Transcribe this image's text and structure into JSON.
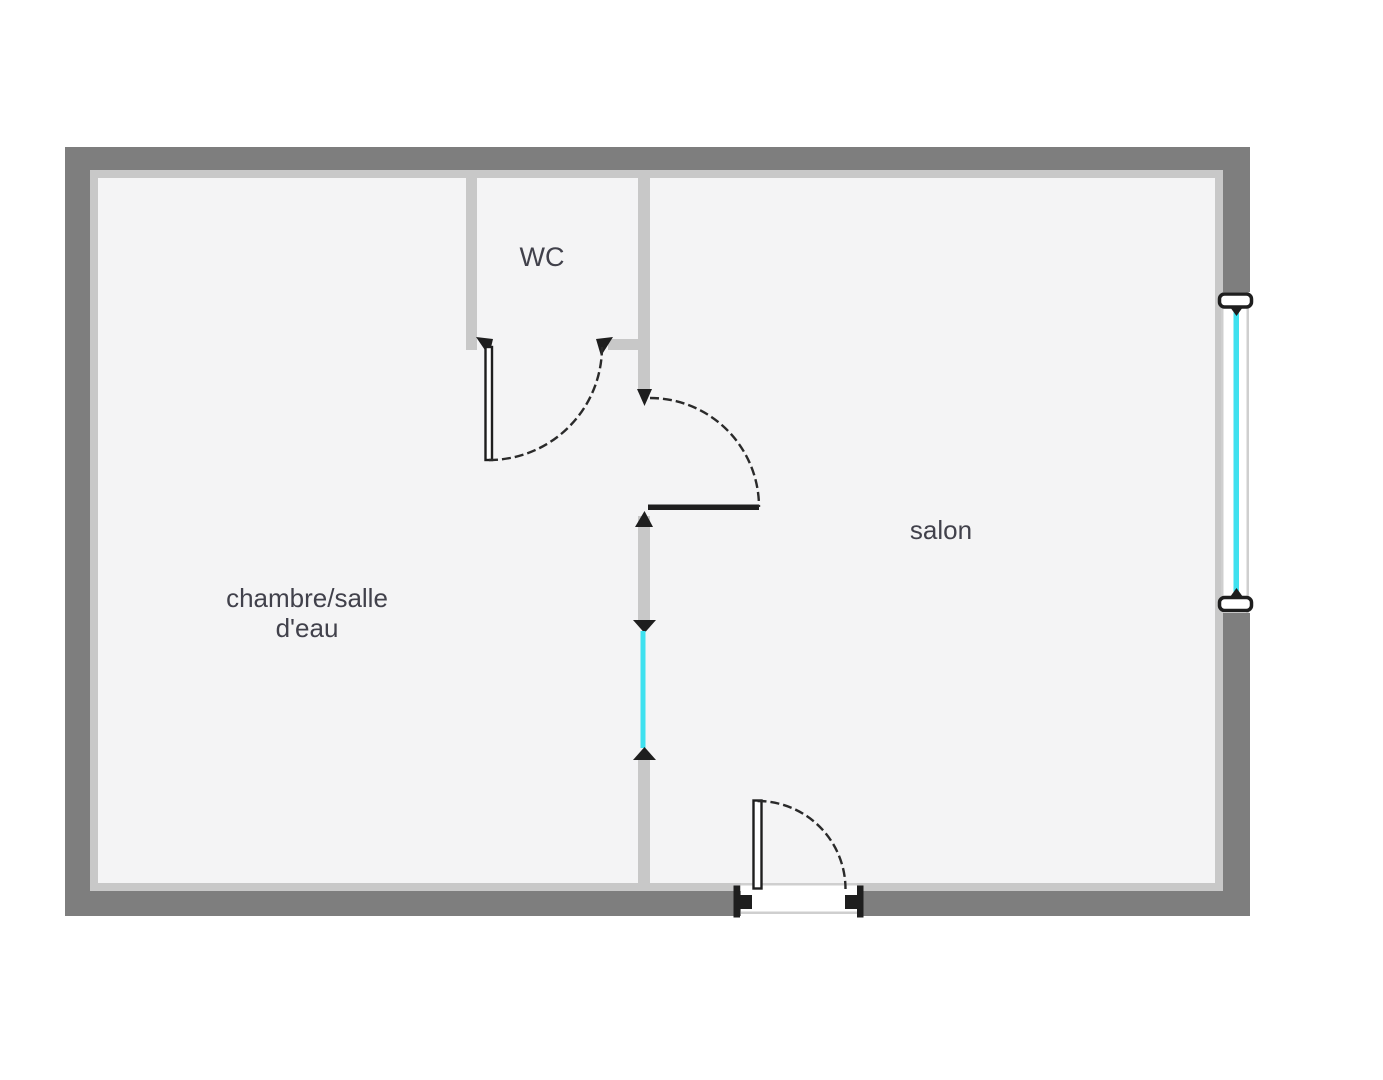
{
  "rooms": {
    "wc": {
      "label": "WC"
    },
    "salon": {
      "label": "salon"
    },
    "chambre": {
      "label_line1": "chambre/salle",
      "label_line2": "d'eau"
    }
  },
  "colors": {
    "wall-dark": "#7e7e7e",
    "wall-light": "#c8c8c8",
    "floor": "#f4f4f5",
    "door": "#1e1e1e",
    "window-glass": "#3ee1ef",
    "label": "#41414b",
    "threshold": "#cfcfcf",
    "background": "#ffffff"
  }
}
